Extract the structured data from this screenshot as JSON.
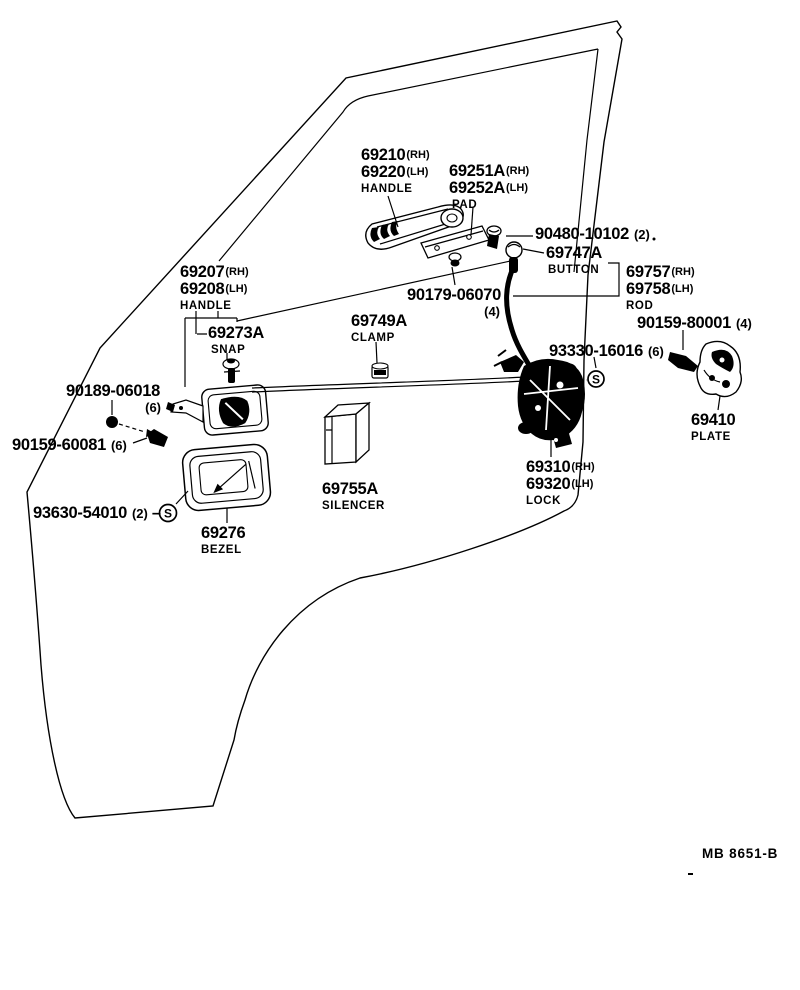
{
  "colors": {
    "ink": "#000000",
    "paper": "#ffffff"
  },
  "symbols": {
    "s_marker": "S"
  },
  "footer": {
    "code": "MB 8651-B"
  },
  "labels": {
    "outer_handle": {
      "rows": [
        {
          "num": "69210",
          "suf": "(RH)"
        },
        {
          "num": "69220",
          "suf": "(LH)"
        }
      ],
      "caption": "HANDLE"
    },
    "pad": {
      "rows": [
        {
          "num": "69251A",
          "suf": "(RH)"
        },
        {
          "num": "69252A",
          "suf": "(LH)"
        }
      ],
      "caption": "PAD"
    },
    "fastener_90480": {
      "num": "90480-10102",
      "qty": "(2)"
    },
    "button": {
      "num": "69747A",
      "caption": "BUTTON"
    },
    "rod": {
      "rows": [
        {
          "num": "69757",
          "suf": "(RH)"
        },
        {
          "num": "69758",
          "suf": "(LH)"
        }
      ],
      "caption": "ROD"
    },
    "inner_handle": {
      "rows": [
        {
          "num": "69207",
          "suf": "(RH)"
        },
        {
          "num": "69208",
          "suf": "(LH)"
        }
      ],
      "caption": "HANDLE"
    },
    "snap": {
      "num": "69273A",
      "caption": "SNAP"
    },
    "clamp": {
      "num": "69749A",
      "caption": "CLAMP"
    },
    "clip_90179": {
      "num": "90179-06070",
      "qty": "(4)"
    },
    "screw_93330": {
      "num": "93330-16016",
      "qty": "(6)"
    },
    "screw_90159_80001": {
      "num": "90159-80001",
      "qty": "(4)"
    },
    "plate": {
      "num": "69410",
      "caption": "PLATE"
    },
    "lock": {
      "rows": [
        {
          "num": "69310",
          "suf": "(RH)"
        },
        {
          "num": "69320",
          "suf": "(LH)"
        }
      ],
      "caption": "LOCK"
    },
    "screw_90189": {
      "num": "90189-06018",
      "qty": "(6)"
    },
    "screw_90159_60081": {
      "num": "90159-60081",
      "qty": "(6)"
    },
    "screw_93630": {
      "num": "93630-54010",
      "qty": "(2)"
    },
    "bezel": {
      "num": "69276",
      "caption": "BEZEL"
    },
    "silencer": {
      "num": "69755A",
      "caption": "SILENCER"
    }
  }
}
